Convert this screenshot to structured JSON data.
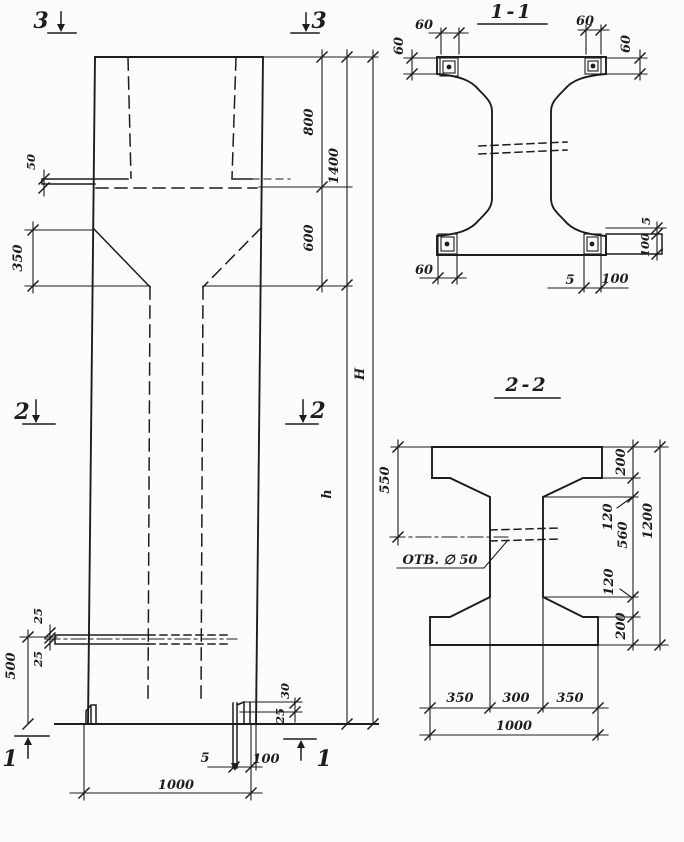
{
  "colors": {
    "ink": "#1d1d1d",
    "paper": "#fcfcfa"
  },
  "elevation": {
    "markers": {
      "top_left": "3",
      "top_right": "3",
      "mid_left": "2",
      "mid_right": "2",
      "bottom_left": "1",
      "bottom_right": "1"
    },
    "dims": {
      "upper_800": "800",
      "upper_total_1400": "1400",
      "taper_600": "600",
      "ledge_50": "50",
      "taper_left_350": "350",
      "total_H": "H",
      "shaft_h": "h",
      "bottom_500": "500",
      "rail_25_top": "25",
      "rail_25_bottom": "25",
      "foot_30": "30",
      "foot_25": "25",
      "baseplate_5": "5",
      "baseplate_100": "100",
      "width_1000": "1000"
    }
  },
  "section_1_1": {
    "title": "1-1",
    "dims": {
      "top_left_60": "60",
      "left_60": "60",
      "top_right_60": "60",
      "right_60": "60",
      "bottom_left_60": "60",
      "bottom_5": "5",
      "bottom_100": "100",
      "side_5": "5",
      "side_100": "100"
    }
  },
  "section_2_2": {
    "title": "2-2",
    "hole_label": "ОТВ. ∅ 50",
    "dims": {
      "left_550": "550",
      "top_200": "200",
      "chamfer_top_120": "120",
      "web_560": "560",
      "chamfer_bottom_120": "120",
      "bottom_200": "200",
      "height_1200": "1200",
      "bottom_350_left": "350",
      "bottom_300": "300",
      "bottom_350_right": "350",
      "bottom_1000": "1000"
    }
  }
}
